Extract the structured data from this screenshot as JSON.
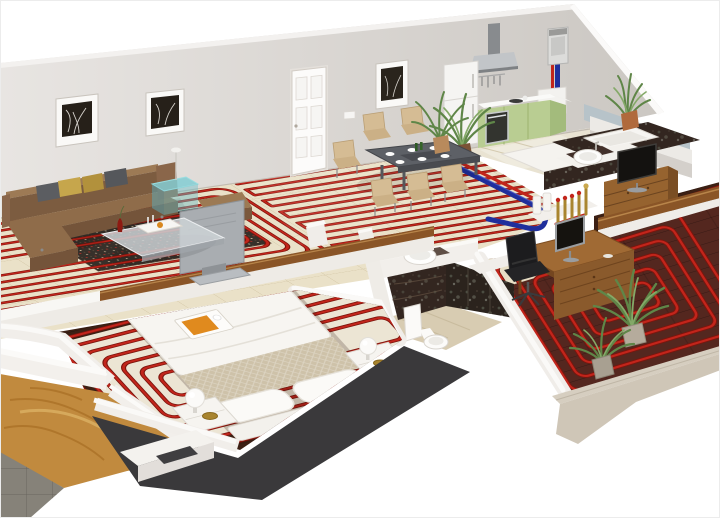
{
  "scene": {
    "description": "3D isometric cutaway floor plan of an apartment showing a red underfloor heating pipe system: serpentine pipe loops in every room, a wall mounted boiler in the kitchen with red and blue supply pipes running to a brass distribution manifold, plus furnished living room, dining area, kitchen, bathroom, home office and two bedrooms",
    "rooms": [
      {
        "name": "living-room",
        "items": [
          "sectional-sofa",
          "gray-and-gold-throw-pillows",
          "dark-speckled-area-rug",
          "glass-coffee-table",
          "serving-tray",
          "red-decor-vase",
          "teal-glass-side-table",
          "slim-floor-lamp",
          "tv-seen-from-behind",
          "brown-ottoman",
          "framed-tree-art-1",
          "framed-tree-art-2",
          "underfloor-pipe-spiral"
        ],
        "floor": "cream-tile"
      },
      {
        "name": "dining-area",
        "items": [
          "dark-top-dining-table",
          "six-beige-chairs",
          "white-plates",
          "green-bottles",
          "potted-palm",
          "framed-tree-art-3",
          "white-paneled-entry-door",
          "underfloor-pipe-serpentine"
        ],
        "floor": "cream-tile"
      },
      {
        "name": "kitchen",
        "items": [
          "stainless-range-hood",
          "hanging-utensils",
          "refrigerator",
          "green-base-cabinets",
          "built-in-oven",
          "white-sink-counter",
          "wall-mounted-boiler",
          "red-supply-pipe",
          "blue-supply-pipe",
          "dark-marble-peninsula",
          "potted-plant"
        ],
        "floor": "beige-tile"
      },
      {
        "name": "bathroom",
        "items": [
          "countertop-vessel-basin",
          "chrome-faucet",
          "dark-marble-vanity",
          "dark-marble-wall-panels",
          "toilet",
          "marble-floor"
        ],
        "floor": "beige-marble"
      },
      {
        "name": "home-office",
        "items": [
          "wooden-desk",
          "computer-monitor",
          "black-office-chair",
          "two-potted-palms",
          "heating-manifold-with-brass-valves",
          "underfloor-pipe-loops"
        ],
        "floor": "dark-wood"
      },
      {
        "name": "bedroom-right",
        "items": [
          "gray-quilted-double-bed",
          "wooden-dresser",
          "flat-screen-tv",
          "inset-bathtub-counter",
          "vessel-sink",
          "tall-potted-plant",
          "wooden-wall-rail",
          "underfloor-pipe-runs"
        ],
        "floor": "dark-wood"
      },
      {
        "name": "bedroom-front",
        "items": [
          "white-double-bed",
          "quilted-beige-footboard",
          "two-white-pillows",
          "orange-breakfast-tray",
          "two-white-nightstands",
          "two-sphere-table-lamps",
          "two-gold-bowls",
          "white-screed-zone",
          "underfloor-pipe-loops"
        ],
        "floor": "dark-wood-planks"
      },
      {
        "name": "exterior-cutaway",
        "items": [
          "balcony-wood-deck",
          "gray-tile-floor",
          "charcoal-slab-edge",
          "cream-slab-edge",
          "white-cut-walls"
        ]
      }
    ]
  },
  "colors": {
    "bg": "#ffffff",
    "wall": "#d9d5d1",
    "wall_light": "#f3f1ef",
    "wall_blue": "#b7c3c9",
    "floor_cream": "#eae1c8",
    "pipe_red": "#c2251b",
    "pipe_dark": "#7c150d",
    "pipe_blue": "#1f2f9c",
    "kitchen_green": "#b9cd92",
    "kitchen_green_dark": "#a3bb7c",
    "steel": "#b7bbbe",
    "wood_office_floor": "#54271f",
    "wood_bedroom_floor": "#3c2014",
    "wood_furniture": "#96632f",
    "wood_rail": "#8a5527",
    "sofa": "#8f6c4a",
    "rug": "#37302a",
    "chair_beige": "#d5bc94",
    "table_gray": "#5d6066",
    "marble_dark": "#332620",
    "marble_floor": "#d8ccb2",
    "bed_white": "#f7f5f1",
    "quilt": "#cec2a9",
    "blanket_gray": "#8e9093",
    "slab_charcoal": "#3a393b",
    "slab_cream": "#d6cec0",
    "balcony_wood": "#c18a3e",
    "tile_gray": "#868279",
    "plant_green": "#5f8648",
    "plant_light": "#84a968",
    "brass": "#a9852f"
  }
}
